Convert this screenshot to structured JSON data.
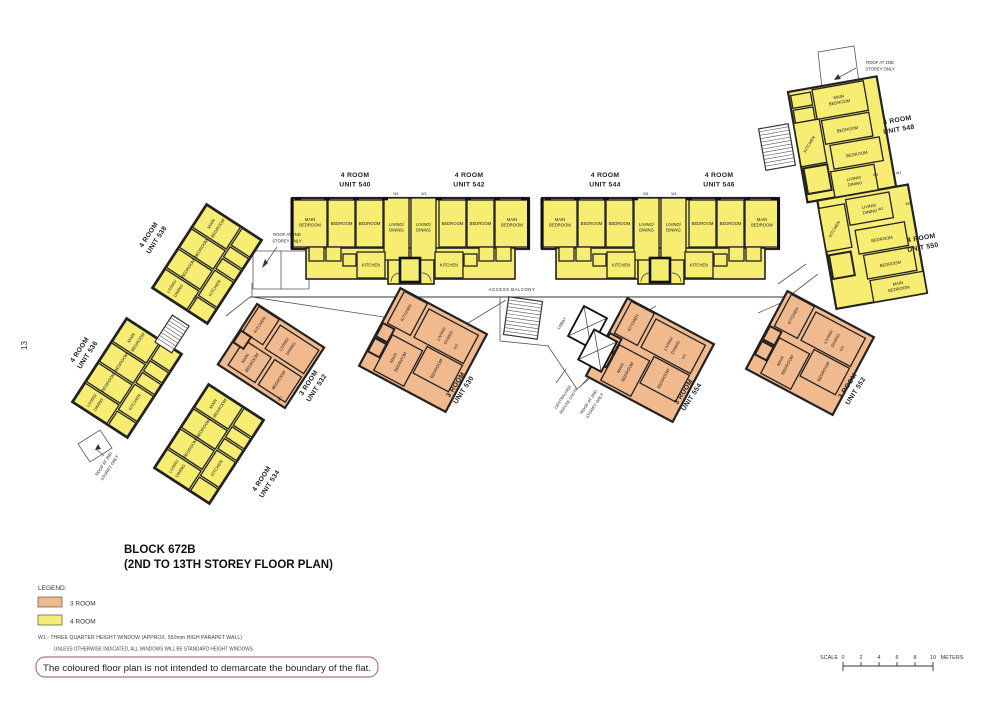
{
  "page_number": "13",
  "title": {
    "line1": "BLOCK 672B",
    "line2": "(2ND TO 13TH STOREY FLOOR PLAN)"
  },
  "legend": {
    "heading": "LEGEND:",
    "items": [
      {
        "label": "3 ROOM",
        "color": "#f1b98e"
      },
      {
        "label": "4 ROOM",
        "color": "#f6ed72"
      }
    ],
    "window_note_line1": "W1 - THREE QUARTER HEIGHT WINDOW (APPROX. 550mm HIGH PARAPET WALL)",
    "window_note_line2": "UNLESS OTHERWISE INDICATED, ALL WINDOWS WILL BE STANDARD HEIGHT WINDOWS."
  },
  "boundary_note": "The coloured floor plan is not intended to demarcate the boundary of the flat.",
  "scale_bar": {
    "label": "SCALE",
    "ticks": [
      "0",
      "2",
      "4",
      "6",
      "8",
      "10"
    ],
    "units": "METERS"
  },
  "annotations": {
    "access_balcony": "ACCESS BALCONY",
    "roof_line1": "ROOF AT 2ND",
    "roof_line2": "STOREY ONLY",
    "refuse_line1": "CENTRALISED",
    "refuse_line2": "REFUSE CHUTE",
    "lobby": "LOBBY",
    "window_mark": "W1"
  },
  "rooms": {
    "main_bedroom_line1": "MAIN",
    "main_bedroom_line2": "BEDROOM",
    "bedroom": "BEDROOM",
    "living_line1": "LIVING/",
    "living_line2": "DINING",
    "kitchen": "KITCHEN"
  },
  "units": {
    "u530": {
      "type_label": "3 ROOM",
      "unit_label": "UNIT 530"
    },
    "u532": {
      "type_label": "3 ROOM",
      "unit_label": "UNIT 532"
    },
    "u534": {
      "type_label": "4 ROOM",
      "unit_label": "UNIT 534"
    },
    "u536": {
      "type_label": "4 ROOM",
      "unit_label": "UNIT 536"
    },
    "u538": {
      "type_label": "4 ROOM",
      "unit_label": "UNIT 538"
    },
    "u540": {
      "type_label": "4 ROOM",
      "unit_label": "UNIT 540"
    },
    "u542": {
      "type_label": "4 ROOM",
      "unit_label": "UNIT 542"
    },
    "u544": {
      "type_label": "4 ROOM",
      "unit_label": "UNIT 544"
    },
    "u546": {
      "type_label": "4 ROOM",
      "unit_label": "UNIT 546"
    },
    "u548": {
      "type_label": "4 ROOM",
      "unit_label": "UNIT 548"
    },
    "u550": {
      "type_label": "4 ROOM",
      "unit_label": "UNIT 550"
    },
    "u552": {
      "type_label": "3 ROOM",
      "unit_label": "UNIT 552"
    },
    "u554": {
      "type_label": "3 ROOM",
      "unit_label": "UNIT 554"
    }
  },
  "colors": {
    "three_room": "#f1b98e",
    "four_room": "#f6ed72",
    "wall": "#1c1c1c",
    "note_box_border": "#b5737d"
  }
}
